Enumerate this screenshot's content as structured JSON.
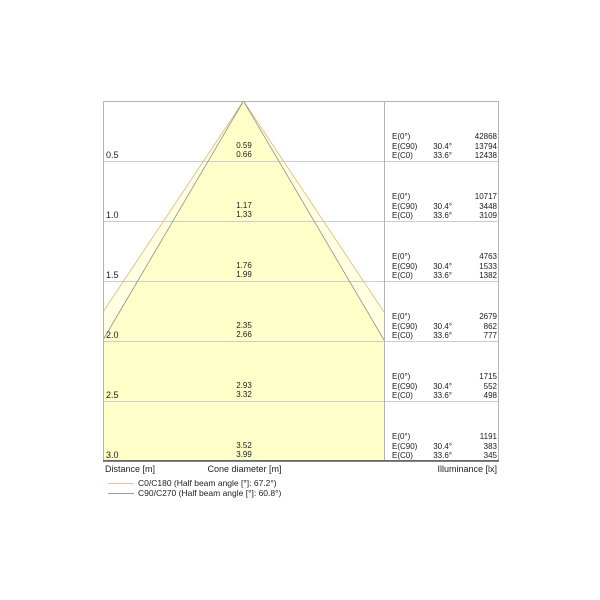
{
  "chart_data": {
    "type": "table",
    "title": "Light cone diagram",
    "xlabel": "Distance [m]",
    "x": [
      0.5,
      1.0,
      1.5,
      2.0,
      2.5,
      3.0
    ],
    "series": [
      {
        "name": "Cone diameter C90/C270 [m]",
        "values": [
          0.59,
          1.17,
          1.76,
          2.35,
          2.93,
          3.52
        ]
      },
      {
        "name": "Cone diameter C0/C180 [m]",
        "values": [
          0.66,
          1.33,
          1.99,
          2.66,
          3.32,
          3.99
        ]
      },
      {
        "name": "E(0°) [lx]",
        "values": [
          42868,
          10717,
          4763,
          2679,
          1715,
          1191
        ]
      },
      {
        "name": "E(C90) [lx]",
        "values": [
          13794,
          3448,
          1533,
          862,
          552,
          383
        ]
      },
      {
        "name": "E(C0) [lx]",
        "values": [
          12438,
          3109,
          1382,
          777,
          498,
          345
        ]
      }
    ],
    "annotations": {
      "ec90_angle": "30.4°",
      "ec0_angle": "33.6°",
      "c0_c180_half_beam_angle": "67.2°",
      "c90_c270_half_beam_angle": "60.8°"
    },
    "legend_position": "bottom",
    "grid": true
  },
  "shared": {
    "e0_label": "E(0°)",
    "ec90_label": "E(C90)",
    "ec0_label": "E(C0)",
    "c90_angle": "30.4°",
    "c0_angle": "33.6°"
  },
  "rows": [
    {
      "distance": "0.5",
      "cone_c90": "0.59",
      "cone_c0": "0.66",
      "e0": "42868",
      "ec90": "13794",
      "ec0": "12438"
    },
    {
      "distance": "1.0",
      "cone_c90": "1.17",
      "cone_c0": "1.33",
      "e0": "10717",
      "ec90": "3448",
      "ec0": "3109"
    },
    {
      "distance": "1.5",
      "cone_c90": "1.76",
      "cone_c0": "1.99",
      "e0": "4763",
      "ec90": "1533",
      "ec0": "1382"
    },
    {
      "distance": "2.0",
      "cone_c90": "2.35",
      "cone_c0": "2.66",
      "e0": "2679",
      "ec90": "862",
      "ec0": "777"
    },
    {
      "distance": "2.5",
      "cone_c90": "2.93",
      "cone_c0": "3.32",
      "e0": "1715",
      "ec90": "552",
      "ec0": "498"
    },
    {
      "distance": "3.0",
      "cone_c90": "3.52",
      "cone_c0": "3.99",
      "e0": "1191",
      "ec90": "383",
      "ec0": "345"
    }
  ],
  "footer": {
    "distance": "Distance [m]",
    "cone": "Cone diameter [m]",
    "illuminance": "Illuminance [lx]"
  },
  "legend": [
    {
      "label": "C0/C180 (Half beam angle [°]: 67.2°)"
    },
    {
      "label": "C90/C270 (Half beam angle [°]: 60.8°)"
    }
  ],
  "colors": {
    "cone_outer_fill": "#ffffe2",
    "cone_inner_fill": "#ffffca",
    "cone_outer_stroke": "#e9c18e",
    "cone_inner_stroke": "#8f8f8f",
    "grid": "#cccccc",
    "border": "#b3b3b3",
    "bottom_border": "#3a3a3a",
    "legend_c0_color": "#e3c49c",
    "legend_c90_color": "#999999"
  }
}
